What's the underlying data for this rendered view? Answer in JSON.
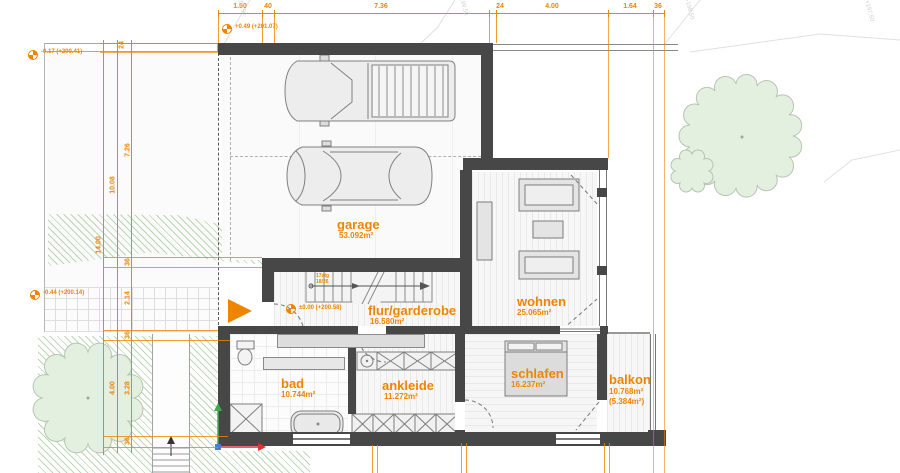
{
  "colors": {
    "accent": "#EE8400",
    "wall": "#474747",
    "hatch_green": "#7AB068",
    "tree_green": "#E3EFDF"
  },
  "rooms": {
    "garage": {
      "name": "garage",
      "area": "53.092m²"
    },
    "flur": {
      "name": "flur/garderobe",
      "area": "16.580m²"
    },
    "wohnen": {
      "name": "wohnen",
      "area": "25.065m²"
    },
    "schlafen": {
      "name": "schlafen",
      "area": "16.237m²"
    },
    "bad": {
      "name": "bad",
      "area": "10.744m²"
    },
    "ankleide": {
      "name": "ankleide",
      "area": "11.272m²"
    },
    "balkon": {
      "name": "balkon",
      "area": "10.768m²",
      "area_secondary": "(5.384m²)"
    }
  },
  "dimensions": {
    "top": [
      "1.50",
      "40",
      "7.36",
      "24",
      "4.00",
      "1.64",
      "36"
    ],
    "left": [
      "24",
      "7.26",
      "10.08",
      "14.00",
      "36",
      "2.14",
      "36",
      "3.28",
      "4.00",
      "36"
    ]
  },
  "levels": {
    "site_upper": "-0.17 (+200.41)",
    "garage": "+0.49 (+201.07)",
    "terrace": "-0.44 (+200.14)",
    "ground_floor": "±0.00 (+200.58)"
  },
  "stairs": {
    "line1": "17stg",
    "line2": "18/26"
  },
  "contour_labels": [
    "+200.50",
    "+199.50",
    "+198.50",
    "+197.50"
  ]
}
